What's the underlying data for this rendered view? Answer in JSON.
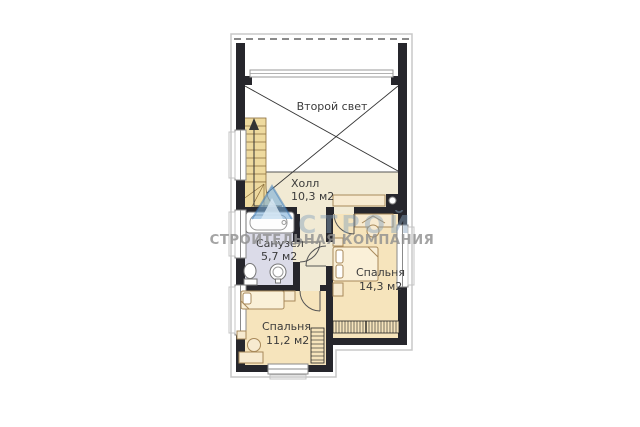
{
  "page": {
    "background": "#ffffff",
    "type": "floor-plan"
  },
  "watermark": {
    "logo_text": "СТРОЙ",
    "company_text": "СТРОИТЕЛЬНАЯ КОМПАНИЯ",
    "logo_color": "#79aed9",
    "text_color": "#8e8e8e"
  },
  "rooms": [
    {
      "name": "Второй свет",
      "area": ""
    },
    {
      "name": "Холл",
      "area": "10,3 м2"
    },
    {
      "name": "Санузел",
      "area": "5,7 м2"
    },
    {
      "name": "Спальня",
      "area": "14,3 м2"
    },
    {
      "name": "Спальня",
      "area": "11,2 м2"
    }
  ],
  "colors": {
    "wall": "#26262c",
    "bedroom_fill": "#f6e4bc",
    "hall_fill": "#f1ead4",
    "bathroom_fill": "#dbdbe8",
    "stairs_fill": "#eeda9f",
    "outline": "#c8c8c8",
    "label": "#3b3b3b"
  }
}
